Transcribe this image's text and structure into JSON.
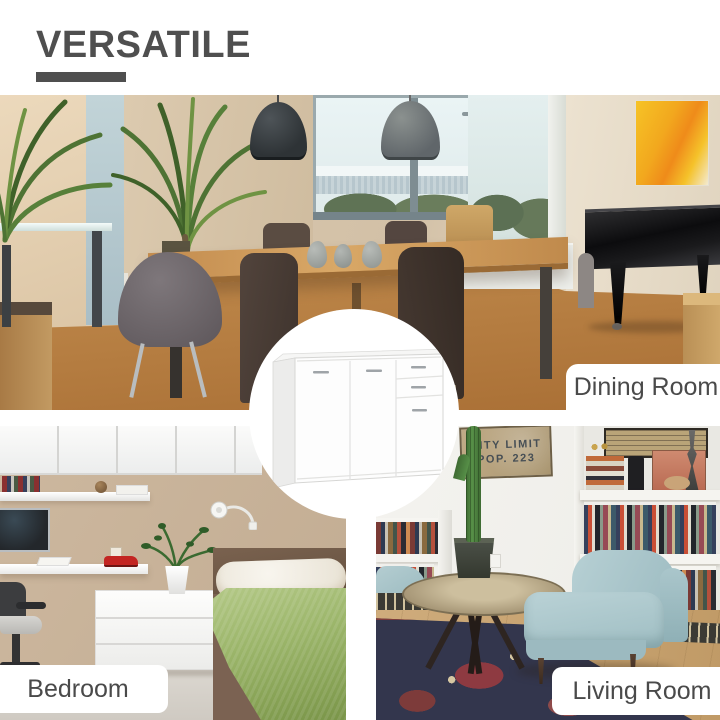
{
  "title": {
    "text": "VERSATILE"
  },
  "rooms": {
    "dining": {
      "label": "Dining Room"
    },
    "bedroom": {
      "label": "Bedroom"
    },
    "living": {
      "label": "Living Room",
      "wall_sign": {
        "line1": "CITY LIMIT",
        "line2": "POP. 223"
      }
    }
  },
  "product": {
    "description": "white sideboard cabinet with 3 doors and 2 drawers"
  },
  "palette": {
    "background": "#ffffff",
    "title_text": "#4f4f4f",
    "label_text": "#4a4a4a",
    "label_background": "#ffffff",
    "dining_wall": "#d9c8b0",
    "dining_floor": "#b9834d",
    "painting_yellow": "#f2b31f",
    "piano_black": "#121214",
    "bedroom_wall": "#c8b299",
    "blanket_green": "#9cb66b",
    "armchair_blue": "#a9c6ca",
    "rug_navy": "#33364d",
    "sideboard_white": "#fdfdfd",
    "handle_gray": "#9fa4a8"
  }
}
